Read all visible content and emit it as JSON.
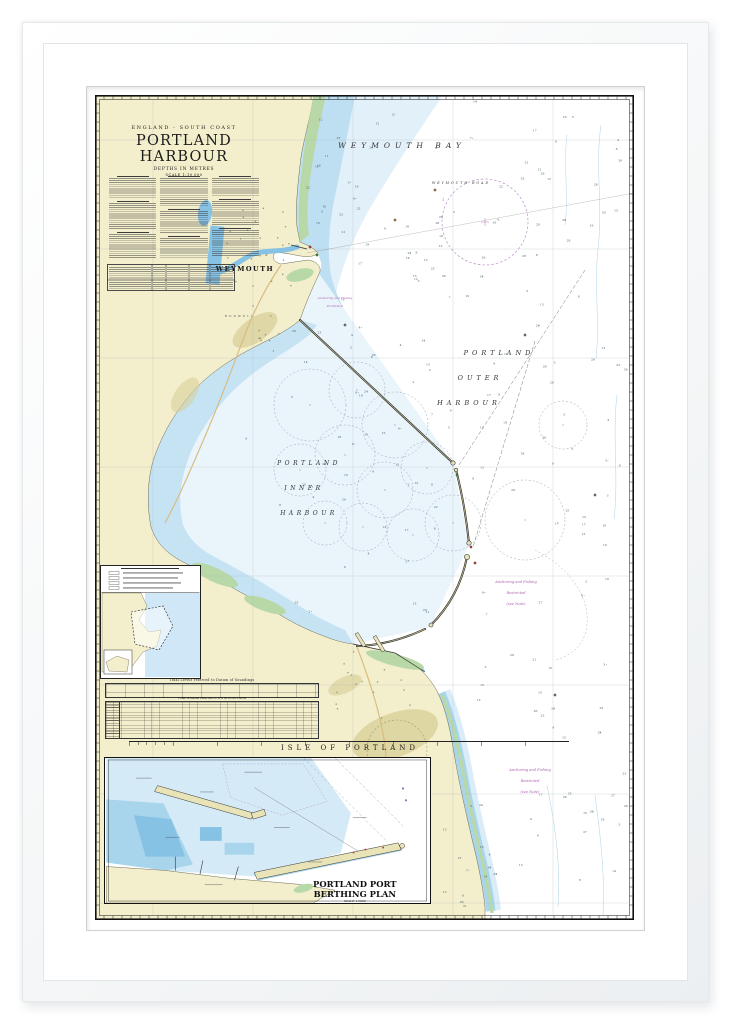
{
  "title_block": {
    "region": "ENGLAND - SOUTH COAST",
    "title": "PORTLAND HARBOUR",
    "depths_note": "DEPTHS IN METRES",
    "scale_note": "SCALE 1:10 000"
  },
  "sea_labels": {
    "weymouth_bay": "WEYMOUTH BAY",
    "weymouth_road": "WEYMOUTH ROAD",
    "outer_harbour": [
      "PORTLAND",
      "OUTER",
      "HARBOUR"
    ],
    "inner_harbour": [
      "PORTLAND",
      "INNER",
      "HARBOUR"
    ]
  },
  "land_labels": {
    "weymouth": "WEYMOUTH",
    "rodwell": "RODWELL",
    "isle_of_portland": "ISLE  OF  PORTLAND"
  },
  "notices": {
    "restricted_outer": [
      "Anchoring and Fishing",
      "Restricted",
      "(see Note)"
    ],
    "restricted_south": [
      "Anchoring and Fishing",
      "Restricted",
      "(see Note)"
    ],
    "prohibited": [
      "Anchoring and Fishing",
      "Prohibited"
    ]
  },
  "tables": {
    "tidal_levels_title": "Tidal Levels referred to Datum of Soundings",
    "tidal_streams_title": "Tidal Streams referred to HW at PORTLAND"
  },
  "berthing_inset": {
    "title_line1": "PORTLAND PORT",
    "title_line2": "BERTHING PLAN",
    "scale_note": "SCALE 1:5000"
  },
  "colors": {
    "land": "#f3eecb",
    "land_dark": "#d9d19c",
    "intertidal": "#b8d8a8",
    "shallow": "#c6e3f4",
    "pale_water": "#e9f4fb",
    "mid_water": "#a9d5ec",
    "deep_water": "#86c2e4",
    "magenta": "#b05fb2",
    "ink": "#1a1a1a"
  }
}
